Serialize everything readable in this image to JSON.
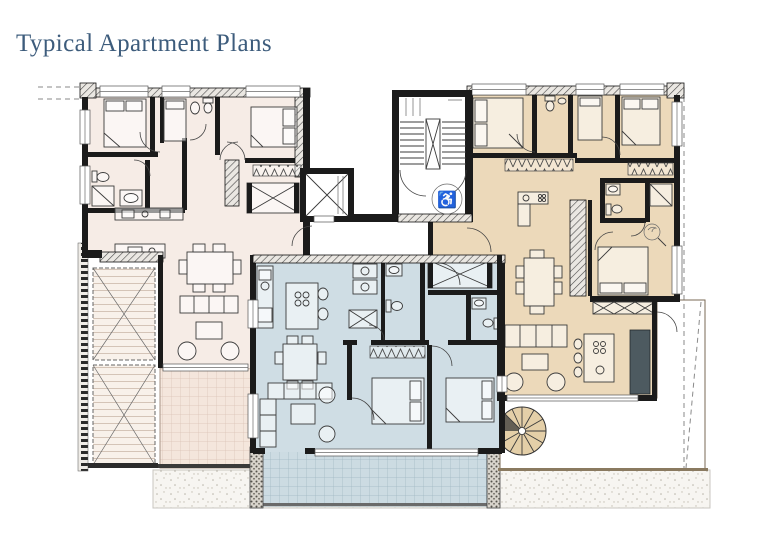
{
  "title": "Typical Apartment Plans",
  "colors": {
    "title_text": "#3d5c7c",
    "unit_left": "#f6ece6",
    "unit_middle": "#cfdde4",
    "unit_right": "#ecd9ba",
    "terrace_left": "#f4e6dc",
    "terrace_middle": "#ccdbe2",
    "terrace_right": "#e9d6b2",
    "wall": "#1b1b1b"
  },
  "icons": {
    "accessibility": "♿"
  }
}
